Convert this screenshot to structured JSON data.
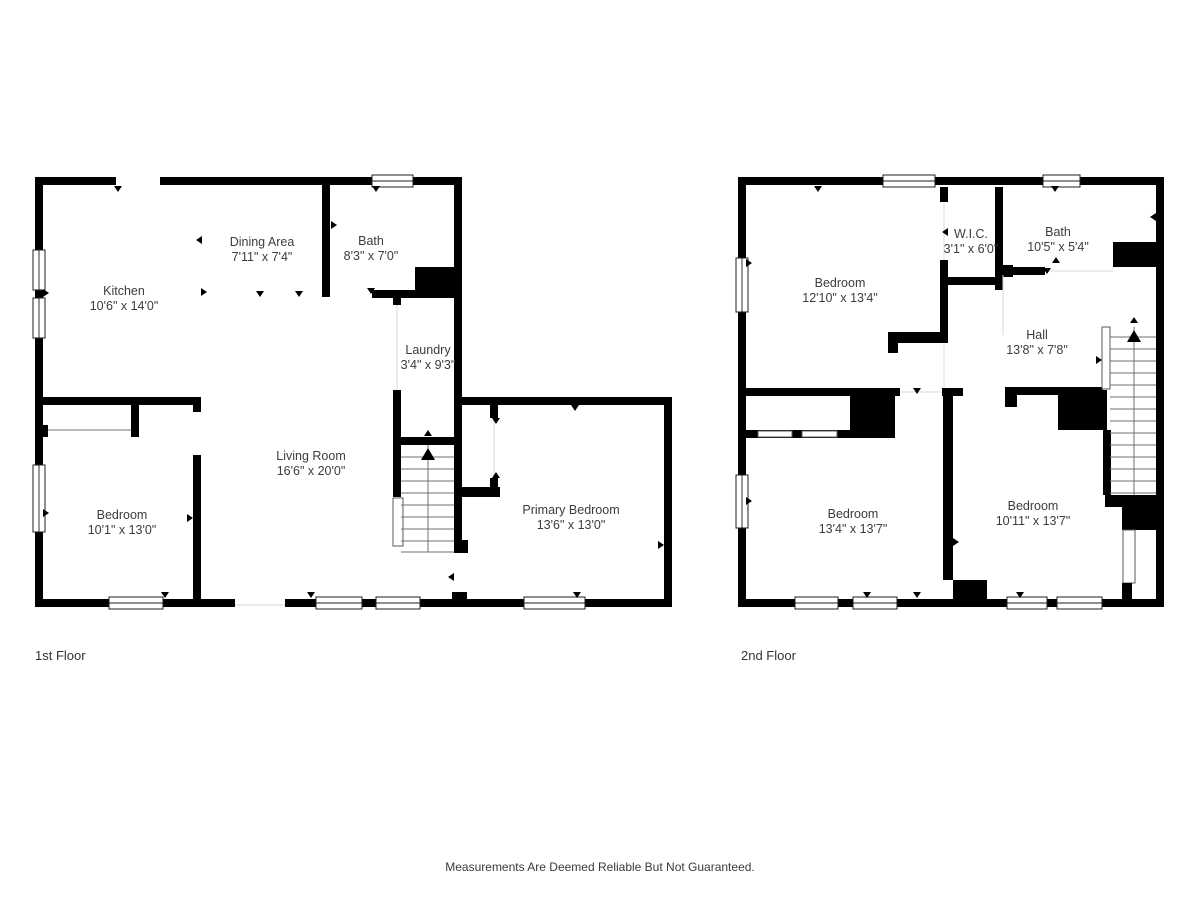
{
  "page": {
    "disclaimer": "Measurements Are Deemed Reliable But Not Guaranteed."
  },
  "colors": {
    "wall": "#000000",
    "background": "#ffffff",
    "label_text": "#3c3c3c"
  },
  "floors": [
    {
      "label": "1st Floor",
      "rooms": [
        {
          "name": "Kitchen",
          "dims": "10'6\" x 14'0\""
        },
        {
          "name": "Dining Area",
          "dims": "7'11\" x 7'4\""
        },
        {
          "name": "Bath",
          "dims": "8'3\" x 7'0\""
        },
        {
          "name": "Laundry",
          "dims": "3'4\" x 9'3\""
        },
        {
          "name": "Living Room",
          "dims": "16'6\" x 20'0\""
        },
        {
          "name": "Bedroom",
          "dims": "10'1\" x 13'0\""
        },
        {
          "name": "Primary Bedroom",
          "dims": "13'6\" x 13'0\""
        }
      ]
    },
    {
      "label": "2nd Floor",
      "rooms": [
        {
          "name": "Bedroom",
          "dims": "12'10\" x 13'4\""
        },
        {
          "name": "W.I.C.",
          "dims": "3'1\" x 6'0\""
        },
        {
          "name": "Bath",
          "dims": "10'5\" x 5'4\""
        },
        {
          "name": "Hall",
          "dims": "13'8\" x 7'8\""
        },
        {
          "name": "Bedroom",
          "dims": "13'4\" x 13'7\""
        },
        {
          "name": "Bedroom",
          "dims": "10'11\" x 13'7\""
        }
      ]
    }
  ]
}
